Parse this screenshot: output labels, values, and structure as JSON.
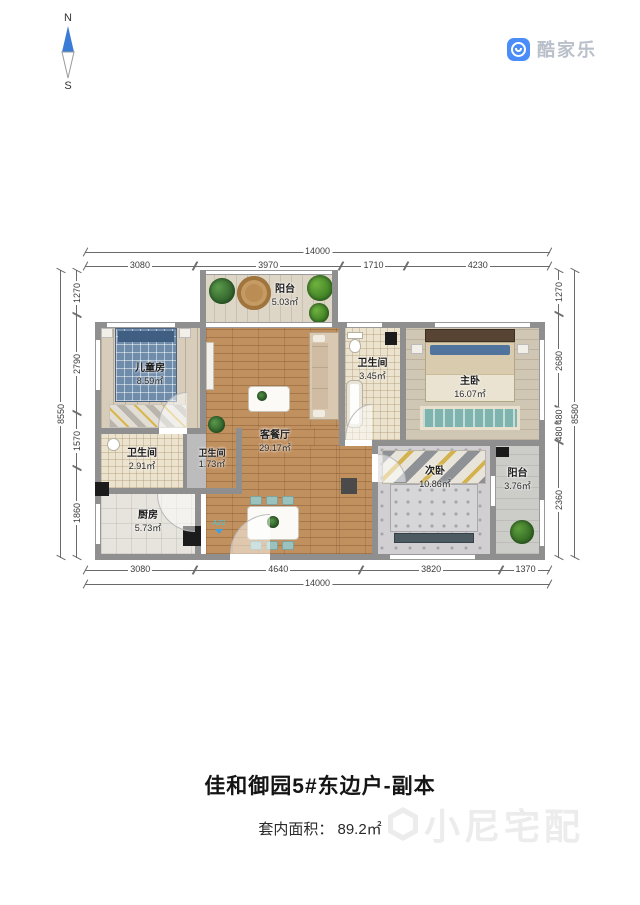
{
  "compass": {
    "north": "N",
    "south": "S"
  },
  "logo": {
    "brand": "酷家乐"
  },
  "plan": {
    "door_label": "A22",
    "rooms": [
      {
        "id": "balcony-top",
        "name": "阳台",
        "area": "5.03㎡"
      },
      {
        "id": "kids-room",
        "name": "儿童房",
        "area": "8.59㎡"
      },
      {
        "id": "bathroom-main",
        "name": "卫生间",
        "area": "3.45㎡"
      },
      {
        "id": "master-bedroom",
        "name": "主卧",
        "area": "16.07㎡"
      },
      {
        "id": "bathroom-left",
        "name": "卫生间",
        "area": "2.91㎡"
      },
      {
        "id": "bathroom-small",
        "name": "卫生间",
        "area": "1.73㎡"
      },
      {
        "id": "living-dining",
        "name": "客餐厅",
        "area": "29.17㎡"
      },
      {
        "id": "kitchen",
        "name": "厨房",
        "area": "5.73㎡"
      },
      {
        "id": "second-bedroom",
        "name": "次卧",
        "area": "10.86㎡"
      },
      {
        "id": "balcony-right",
        "name": "阳台",
        "area": "3.76㎡"
      }
    ],
    "dimensions": {
      "top_total": "14000",
      "top_segments": [
        "3080",
        "3970",
        "1710",
        "4230"
      ],
      "bottom_segments": [
        "3080",
        "4640",
        "3820",
        "1370"
      ],
      "bottom_total": "14000",
      "left_total": "8550",
      "left_segments": [
        "1270",
        "2790",
        "1570",
        "1860"
      ],
      "right_segments": [
        "1270",
        "2680",
        "480",
        "480",
        "2360"
      ],
      "right_total": "8580"
    }
  },
  "footer": {
    "title": "佳和御园5#东边户-副本",
    "area_label": "套内面积： 89.2㎡",
    "watermark": "小尼宅配"
  },
  "colors": {
    "brand_blue": "#4a8df8",
    "compass_blue": "#3a7bd5",
    "wall_gray": "#8f8f8f",
    "watermark_gray": "#ececec",
    "door_label_cyan": "#45c6e0"
  }
}
